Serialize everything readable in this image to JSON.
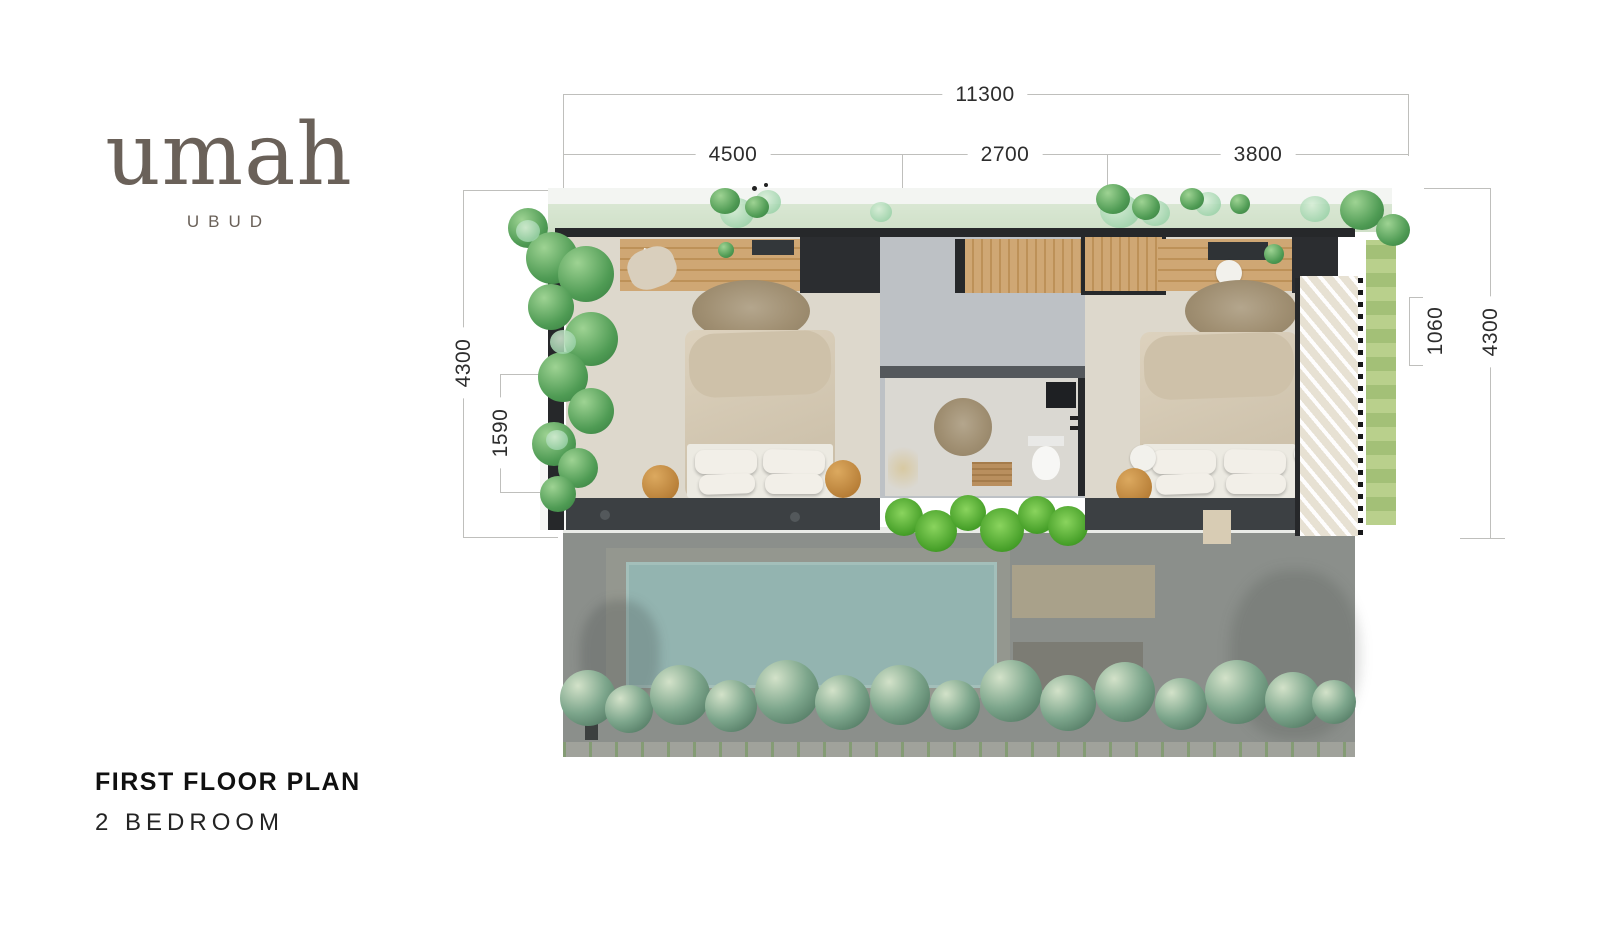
{
  "logo": {
    "brand": "umah",
    "location": "UBUD"
  },
  "title": {
    "heading": "FIRST FLOOR PLAN",
    "subheading": "2 BEDROOM"
  },
  "dimensions": {
    "overall_width": "11300",
    "bedroom_left_width": "4500",
    "core_width": "2700",
    "bedroom_right_width": "3800",
    "depth_left": "4300",
    "terrace_left": "1590",
    "deck_right": "1060",
    "depth_right": "4300"
  },
  "plan": {
    "type": "architectural-floor-plan",
    "floor": "first",
    "bedrooms": 2,
    "features": [
      "bedroom-left",
      "stair-core",
      "bathroom",
      "bedroom-right",
      "side-deck",
      "pool-below",
      "garden-planting"
    ]
  },
  "colors": {
    "logo": "#6a6159",
    "dimension_line": "#bfbfbc",
    "dimension_text": "#2d2d2d",
    "heading_text": "#101010",
    "wall_dark": "#26282a",
    "wood": "#c79e6a",
    "bedroom_floor": "#ddd8cc",
    "pool": "#93b4b0",
    "plant_green": "#4f9b54",
    "dimmed_ground": "#8b8f8b"
  }
}
